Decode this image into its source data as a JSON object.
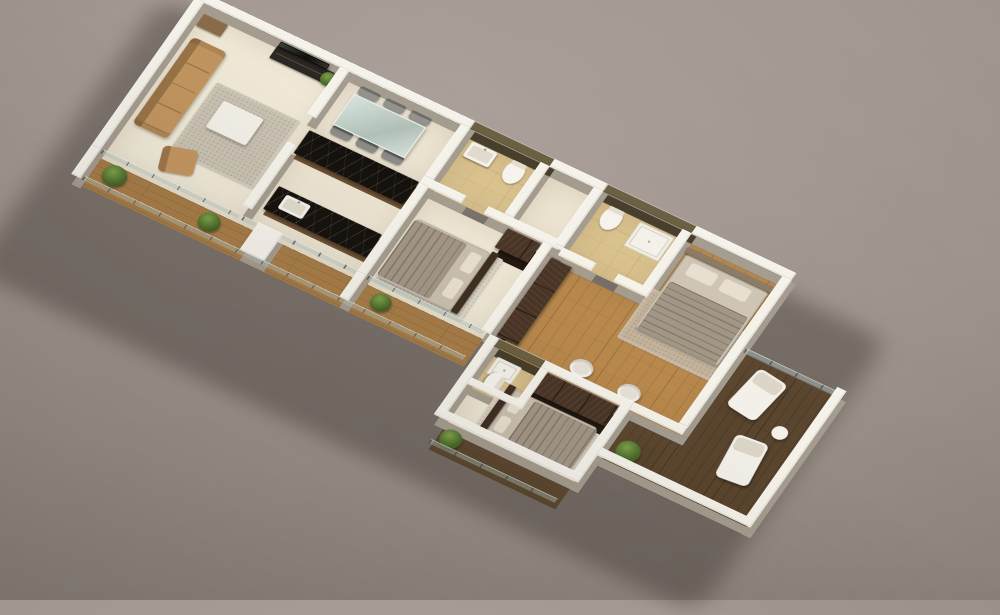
{
  "scene": {
    "description_colors": {
      "backdrop": "#9b9189",
      "wall_white": "#f5f2ea",
      "wall_olive": "#6b5f42",
      "floor_cream": "#efe8d6",
      "floor_tan_bath": "#d9c28e",
      "wood_light": "#b9894d",
      "wood_balcony": "#a97e48",
      "deck_dark": "#5a452e",
      "marble_black": "#16120e",
      "cabinet_brown": "#4a3526",
      "sofa_tan": "#c2955f",
      "bedding_beige": "#c9bfae",
      "plant_green": "#4c6b2a"
    },
    "plan": {
      "width": 1270,
      "height": 560
    },
    "rooms": [
      {
        "name": "living-room-floor",
        "x": 16,
        "y": 16,
        "w": 254,
        "h": 320,
        "color": "#efe8d6"
      },
      {
        "name": "dining-area-floor",
        "x": 270,
        "y": 16,
        "w": 210,
        "h": 114,
        "color": "#ece4d2"
      },
      {
        "name": "kitchen-floor",
        "x": 270,
        "y": 130,
        "w": 210,
        "h": 206,
        "color": "#ece4d2"
      },
      {
        "name": "bathroom1-floor",
        "x": 496,
        "y": 16,
        "w": 144,
        "h": 114,
        "color": "#d9c28e",
        "pattern": "tile"
      },
      {
        "name": "hallway-floor",
        "x": 640,
        "y": 16,
        "w": 96,
        "h": 114,
        "color": "#ece4d2"
      },
      {
        "name": "bedroom1-floor",
        "x": 496,
        "y": 146,
        "w": 208,
        "h": 190,
        "color": "#efe8d6"
      },
      {
        "name": "bathroom2-floor",
        "x": 736,
        "y": 16,
        "w": 144,
        "h": 124,
        "color": "#d9c28e",
        "pattern": "tile"
      },
      {
        "name": "master-bedroom-floor",
        "x": 736,
        "y": 156,
        "w": 324,
        "h": 184,
        "color": "#b9894d",
        "pattern": "parquet"
      },
      {
        "name": "master-bedroom-floor-upper",
        "x": 896,
        "y": 16,
        "w": 164,
        "h": 140,
        "color": "#b9894d",
        "pattern": "parquet"
      },
      {
        "name": "bedroom3-floor",
        "x": 736,
        "y": 356,
        "w": 228,
        "h": 144,
        "color": "#efe8d6"
      },
      {
        "name": "bathroom3-floor",
        "x": 736,
        "y": 356,
        "w": 84,
        "h": 84,
        "color": "#d9c28e",
        "pattern": "tile"
      },
      {
        "name": "balcony-front-floor",
        "x": 16,
        "y": 336,
        "w": 688,
        "h": 60,
        "color": "#a97e48",
        "pattern": "plank-x"
      },
      {
        "name": "balcony-right-floor",
        "x": 1076,
        "y": 156,
        "w": 164,
        "h": 300,
        "color": "#5a452e",
        "pattern": "plank-y"
      },
      {
        "name": "balcony-right-corner-floor",
        "x": 980,
        "y": 356,
        "w": 96,
        "h": 100,
        "color": "#5a452e",
        "pattern": "plank-y"
      },
      {
        "name": "balcony-bottom-deck-floor",
        "x": 736,
        "y": 516,
        "w": 228,
        "h": 44,
        "color": "#5a452e",
        "pattern": "plank-x"
      }
    ],
    "walls": [
      {
        "name": "wall-top-living",
        "x": 0,
        "y": 0,
        "w": 496,
        "h": 16
      },
      {
        "name": "wall-top-bath1",
        "x": 496,
        "y": 0,
        "w": 144,
        "h": 16,
        "color": "#6b5f42",
        "base": "#463d2a"
      },
      {
        "name": "wall-top-hall",
        "x": 640,
        "y": 0,
        "w": 96,
        "h": 16
      },
      {
        "name": "wall-top-bath2",
        "x": 736,
        "y": 0,
        "w": 160,
        "h": 16,
        "color": "#6b5f42",
        "base": "#463d2a"
      },
      {
        "name": "wall-top-master",
        "x": 896,
        "y": 0,
        "w": 180,
        "h": 16
      },
      {
        "name": "wall-left-living",
        "x": 0,
        "y": 16,
        "w": 16,
        "h": 324
      },
      {
        "name": "wall-left-balcony-end",
        "x": 0,
        "y": 340,
        "w": 16,
        "h": 62
      },
      {
        "name": "wall-tv-divider",
        "x": 262,
        "y": 16,
        "w": 16,
        "h": 104
      },
      {
        "name": "wall-living-kitchen",
        "x": 262,
        "y": 180,
        "w": 16,
        "h": 140
      },
      {
        "name": "wall-dining-bath1",
        "x": 480,
        "y": 16,
        "w": 16,
        "h": 114
      },
      {
        "name": "wall-bath1-bottom-left",
        "x": 480,
        "y": 130,
        "w": 76,
        "h": 16
      },
      {
        "name": "wall-bath1-bottom-right",
        "x": 596,
        "y": 130,
        "w": 140,
        "h": 16
      },
      {
        "name": "wall-bath1-hall",
        "x": 624,
        "y": 16,
        "w": 16,
        "h": 114
      },
      {
        "name": "wall-kitchen-bedroom1",
        "x": 480,
        "y": 146,
        "w": 16,
        "h": 194
      },
      {
        "name": "wall-bedroom1-right",
        "x": 704,
        "y": 146,
        "w": 16,
        "h": 194
      },
      {
        "name": "wall-hall-bath2",
        "x": 720,
        "y": 16,
        "w": 16,
        "h": 124
      },
      {
        "name": "wall-bath2-right",
        "x": 880,
        "y": 16,
        "w": 16,
        "h": 140
      },
      {
        "name": "wall-bath2-master-left",
        "x": 736,
        "y": 140,
        "w": 60,
        "h": 16
      },
      {
        "name": "wall-bath2-master-right",
        "x": 836,
        "y": 140,
        "w": 60,
        "h": 16
      },
      {
        "name": "wall-master-right",
        "x": 1060,
        "y": 16,
        "w": 16,
        "h": 324
      },
      {
        "name": "wall-master-bottom-corner",
        "x": 980,
        "y": 340,
        "w": 96,
        "h": 16
      },
      {
        "name": "wall-bedroom3-left",
        "x": 720,
        "y": 340,
        "w": 16,
        "h": 176
      },
      {
        "name": "wall-bath3-top",
        "x": 736,
        "y": 340,
        "w": 84,
        "h": 16,
        "color": "#6b5f42",
        "base": "#463d2a"
      },
      {
        "name": "wall-bedroom3-top",
        "x": 820,
        "y": 340,
        "w": 160,
        "h": 16
      },
      {
        "name": "wall-bedroom3-right",
        "x": 964,
        "y": 340,
        "w": 16,
        "h": 176
      },
      {
        "name": "wall-bedroom3-bottom",
        "x": 720,
        "y": 500,
        "w": 260,
        "h": 16
      },
      {
        "name": "wall-bath3-right",
        "x": 820,
        "y": 356,
        "w": 14,
        "h": 84
      },
      {
        "name": "wall-bath3-bottom",
        "x": 736,
        "y": 426,
        "w": 98,
        "h": 14
      },
      {
        "name": "wall-balcony-jut",
        "x": 300,
        "y": 336,
        "w": 44,
        "h": 60
      },
      {
        "name": "wall-parapet-right",
        "x": 1240,
        "y": 156,
        "w": 16,
        "h": 300
      },
      {
        "name": "wall-parapet-bottom-right",
        "x": 980,
        "y": 440,
        "w": 276,
        "h": 16
      },
      {
        "name": "wall-balcony-stub",
        "x": 480,
        "y": 340,
        "w": 16,
        "h": 56
      }
    ],
    "rails": [
      {
        "name": "glass-railing-living-window",
        "x": 16,
        "y": 330,
        "w": 246,
        "h": 8
      },
      {
        "name": "glass-railing-kitchen-window",
        "x": 270,
        "y": 330,
        "w": 210,
        "h": 8
      },
      {
        "name": "glass-railing-bedroom1-window",
        "x": 496,
        "y": 330,
        "w": 208,
        "h": 8
      },
      {
        "name": "glass-railing-balcony-front",
        "x": 16,
        "y": 388,
        "w": 688,
        "h": 8
      },
      {
        "name": "glass-railing-balcony-right-top",
        "x": 1076,
        "y": 156,
        "w": 164,
        "h": 8
      },
      {
        "name": "glass-railing-bottom-deck",
        "x": 736,
        "y": 552,
        "w": 228,
        "h": 8
      }
    ],
    "items": [
      {
        "name": "living-room-rug",
        "type": "rug",
        "x": 100,
        "y": 120,
        "w": 150,
        "h": 150,
        "color": "#c9c2b2",
        "z": 2
      },
      {
        "name": "living-room-sofa",
        "type": "sofa",
        "x": 28,
        "y": 70,
        "w": 62,
        "h": 190,
        "color": "#c2955f",
        "z": 12
      },
      {
        "name": "living-room-armchair",
        "type": "chair-arm",
        "x": 98,
        "y": 262,
        "w": 56,
        "h": 50,
        "color": "#c2955f",
        "z": 12,
        "rot": -18
      },
      {
        "name": "coffee-table",
        "type": "table-white",
        "x": 130,
        "y": 150,
        "w": 72,
        "h": 58,
        "color": "#f2efe7",
        "z": 10
      },
      {
        "name": "tv-unit",
        "type": "tvunit",
        "x": 150,
        "y": 18,
        "w": 104,
        "h": 26,
        "color": "#2c2723",
        "z": 10
      },
      {
        "name": "tv-screen",
        "type": "tv",
        "x": 158,
        "y": 20,
        "w": 86,
        "h": 9,
        "color": "#121110",
        "z": 30
      },
      {
        "name": "living-side-cabinet",
        "type": "console-small",
        "x": 20,
        "y": 22,
        "w": 44,
        "h": 26,
        "color": "#8a6b49",
        "z": 10
      },
      {
        "name": "living-corner-plant",
        "type": "plant",
        "x": 240,
        "y": 24,
        "w": 26,
        "h": 26,
        "z": 16
      },
      {
        "name": "dining-table",
        "type": "table-glass",
        "x": 300,
        "y": 38,
        "w": 126,
        "h": 64,
        "color": "rgba(190,205,198,0.6)",
        "z": 12
      },
      {
        "name": "dining-chair",
        "type": "chair",
        "x": 302,
        "y": 18,
        "w": 36,
        "h": 18,
        "color": "#93928c",
        "z": 10
      },
      {
        "name": "dining-chair",
        "type": "chair",
        "x": 348,
        "y": 18,
        "w": 36,
        "h": 18,
        "color": "#93928c",
        "z": 10
      },
      {
        "name": "dining-chair",
        "type": "chair",
        "x": 394,
        "y": 18,
        "w": 36,
        "h": 18,
        "color": "#93928c",
        "z": 10
      },
      {
        "name": "dining-chair",
        "type": "chair",
        "x": 302,
        "y": 104,
        "w": 36,
        "h": 18,
        "color": "#8c8b85",
        "z": 10
      },
      {
        "name": "dining-chair",
        "type": "chair",
        "x": 348,
        "y": 104,
        "w": 36,
        "h": 18,
        "color": "#8c8b85",
        "z": 10
      },
      {
        "name": "dining-chair",
        "type": "chair",
        "x": 394,
        "y": 104,
        "w": 36,
        "h": 18,
        "color": "#8c8b85",
        "z": 10
      },
      {
        "name": "kitchen-counter-upper",
        "type": "counter",
        "x": 276,
        "y": 136,
        "w": 198,
        "h": 50,
        "color": "#16120e",
        "z": 16
      },
      {
        "name": "kitchen-counter-lower",
        "type": "counter",
        "x": 288,
        "y": 252,
        "w": 186,
        "h": 50,
        "color": "#16120e",
        "z": 16
      },
      {
        "name": "kitchen-sink",
        "type": "sink",
        "x": 308,
        "y": 262,
        "w": 44,
        "h": 30,
        "z": 20
      },
      {
        "name": "bathroom1-sink",
        "type": "sink",
        "x": 508,
        "y": 28,
        "w": 46,
        "h": 32,
        "z": 18
      },
      {
        "name": "bathroom1-toilet",
        "type": "toilet",
        "x": 576,
        "y": 24,
        "w": 32,
        "h": 44,
        "z": 14
      },
      {
        "name": "bathroom2-toilet",
        "type": "toilet",
        "x": 752,
        "y": 24,
        "w": 32,
        "h": 44,
        "z": 14
      },
      {
        "name": "bathroom2-shower-tray",
        "type": "shower",
        "x": 808,
        "y": 24,
        "w": 62,
        "h": 52,
        "z": 8
      },
      {
        "name": "bedroom1-rug",
        "type": "rug",
        "x": 500,
        "y": 190,
        "w": 158,
        "h": 136,
        "color": "#d3ccbc",
        "z": 2
      },
      {
        "name": "bedroom1-bed",
        "type": "bed",
        "x": 506,
        "y": 196,
        "w": 132,
        "h": 128,
        "color": "#c9bfae",
        "z": 14,
        "dir": "right"
      },
      {
        "name": "bedroom1-headboard",
        "type": "headboard",
        "x": 640,
        "y": 194,
        "w": 12,
        "h": 132,
        "color": "#3f2f22",
        "z": 18
      },
      {
        "name": "bedroom1-wardrobe",
        "type": "wardrobe",
        "x": 642,
        "y": 150,
        "w": 60,
        "h": 42,
        "color": "#4a3526",
        "z": 28
      },
      {
        "name": "master-dresser",
        "type": "dresser",
        "x": 726,
        "y": 160,
        "w": 38,
        "h": 172,
        "color": "#4a3526",
        "z": 20
      },
      {
        "name": "master-rug",
        "type": "rug",
        "x": 884,
        "y": 120,
        "w": 176,
        "h": 110,
        "color": "#c3b29b",
        "z": 2
      },
      {
        "name": "master-bed",
        "type": "bed",
        "x": 904,
        "y": 44,
        "w": 148,
        "h": 162,
        "color": "#cfc5b5",
        "z": 14,
        "dir": "top"
      },
      {
        "name": "master-headboard",
        "type": "headboard",
        "x": 900,
        "y": 34,
        "w": 156,
        "h": 12,
        "color": "#8b7a64",
        "z": 18
      },
      {
        "name": "master-tub-chair",
        "type": "tubchair",
        "x": 850,
        "y": 296,
        "w": 38,
        "h": 34,
        "z": 10
      },
      {
        "name": "master-tub-chair",
        "type": "tubchair",
        "x": 938,
        "y": 300,
        "w": 38,
        "h": 34,
        "z": 10
      },
      {
        "name": "bathroom3-shower-tray",
        "type": "shower",
        "x": 744,
        "y": 358,
        "w": 44,
        "h": 36,
        "z": 8
      },
      {
        "name": "bathroom3-toilet",
        "type": "toilet",
        "x": 744,
        "y": 394,
        "w": 42,
        "h": 28,
        "z": 14,
        "rot": 90
      },
      {
        "name": "bedroom3-wardrobe",
        "type": "wardrobe",
        "x": 822,
        "y": 358,
        "w": 140,
        "h": 44,
        "color": "#4a3526",
        "z": 28
      },
      {
        "name": "bedroom3-rug",
        "type": "rug",
        "x": 776,
        "y": 406,
        "w": 176,
        "h": 88,
        "color": "#d3ccbc",
        "z": 2
      },
      {
        "name": "bedroom3-bed",
        "type": "bed",
        "x": 800,
        "y": 402,
        "w": 150,
        "h": 94,
        "color": "#c9bfae",
        "z": 14,
        "dir": "left"
      },
      {
        "name": "bedroom3-headboard",
        "type": "headboard",
        "x": 790,
        "y": 400,
        "w": 12,
        "h": 98,
        "color": "#3f2f22",
        "z": 18
      },
      {
        "name": "balcony-plant",
        "type": "plant",
        "x": 36,
        "y": 344,
        "w": 40,
        "h": 40,
        "z": 16
      },
      {
        "name": "balcony-plant",
        "type": "plant",
        "x": 210,
        "y": 348,
        "w": 36,
        "h": 36,
        "z": 16
      },
      {
        "name": "balcony-plant",
        "type": "plant",
        "x": 520,
        "y": 348,
        "w": 34,
        "h": 34,
        "z": 16
      },
      {
        "name": "balcony-right-plant",
        "type": "plant",
        "x": 994,
        "y": 398,
        "w": 40,
        "h": 40,
        "z": 16
      },
      {
        "name": "bottom-deck-plant",
        "type": "plant",
        "x": 744,
        "y": 518,
        "w": 36,
        "h": 36,
        "z": 16
      },
      {
        "name": "balcony-lounge-chair",
        "type": "lounger",
        "x": 1104,
        "y": 176,
        "w": 56,
        "h": 88,
        "z": 10,
        "rot": 8
      },
      {
        "name": "balcony-lounge-chair",
        "type": "lounger",
        "x": 1146,
        "y": 296,
        "w": 56,
        "h": 88,
        "z": 10,
        "rot": -6
      },
      {
        "name": "balcony-side-table",
        "type": "roundtable",
        "x": 1186,
        "y": 252,
        "w": 26,
        "h": 26,
        "z": 10
      }
    ]
  }
}
